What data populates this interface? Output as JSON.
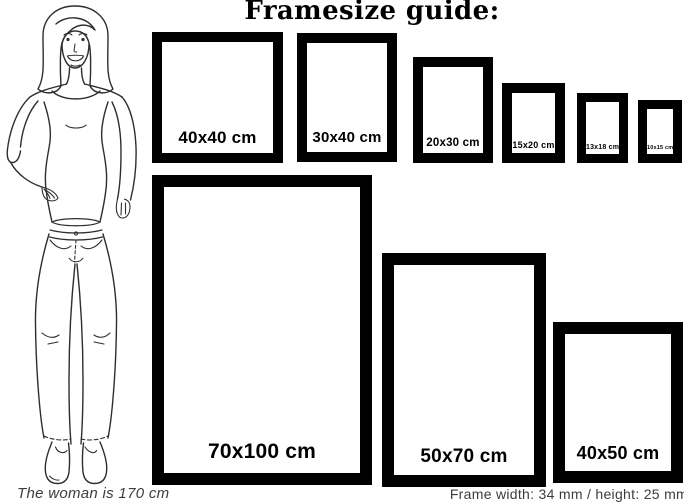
{
  "title": "Framesize guide:",
  "frames": [
    {
      "label": "40x40 cm"
    },
    {
      "label": "30x40 cm"
    },
    {
      "label": "20x30 cm"
    },
    {
      "label": "15x20 cm"
    },
    {
      "label": "13x18 cm"
    },
    {
      "label": "10x15 cm"
    },
    {
      "label": "70x100 cm"
    },
    {
      "label": "50x70 cm"
    },
    {
      "label": "40x50 cm"
    }
  ],
  "footer": {
    "left_note": "The woman is 170 cm",
    "right_note": "Frame width: 34 mm / height: 25 mm"
  },
  "illustration": "woman-line-drawing",
  "colors": {
    "frame": "#000000",
    "background": "#ffffff",
    "note_text": "#3d3d3d"
  }
}
